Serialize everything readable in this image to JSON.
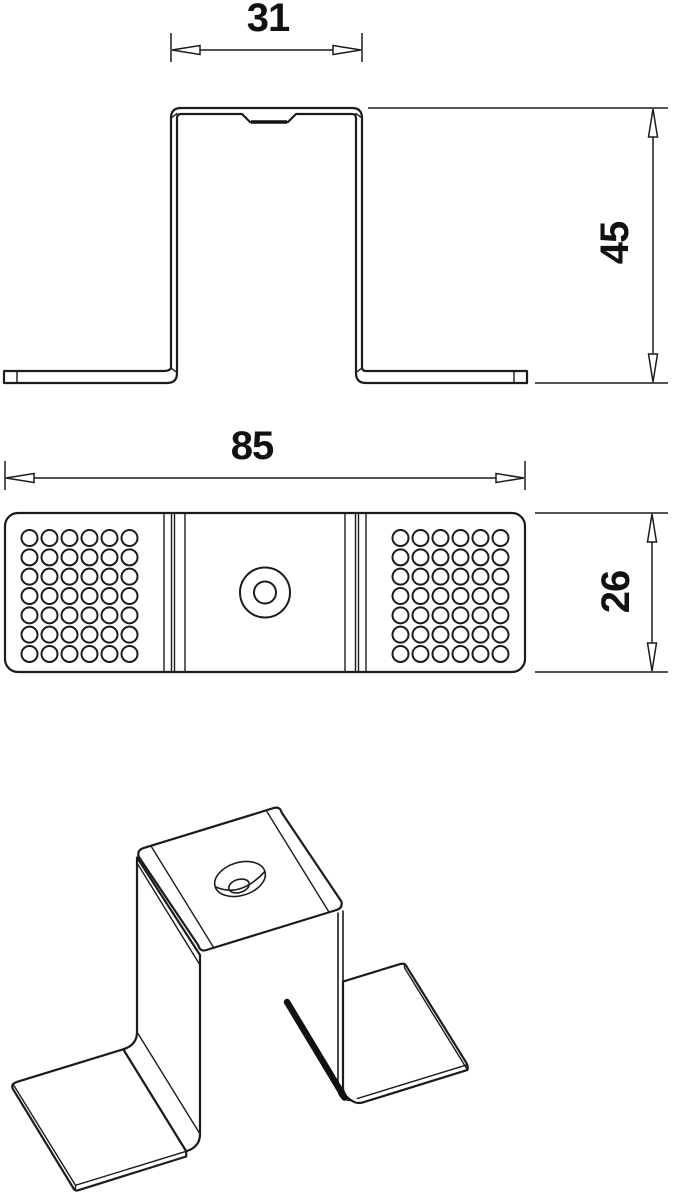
{
  "drawing": {
    "dimensions": {
      "hat_width": "31",
      "height": "45",
      "length": "85",
      "depth": "26"
    },
    "perforation_grid": {
      "columns": 6,
      "rows": 7
    },
    "colors": {
      "line": "#1c1c1c",
      "background": "#ffffff",
      "shadow": "#111111"
    }
  }
}
